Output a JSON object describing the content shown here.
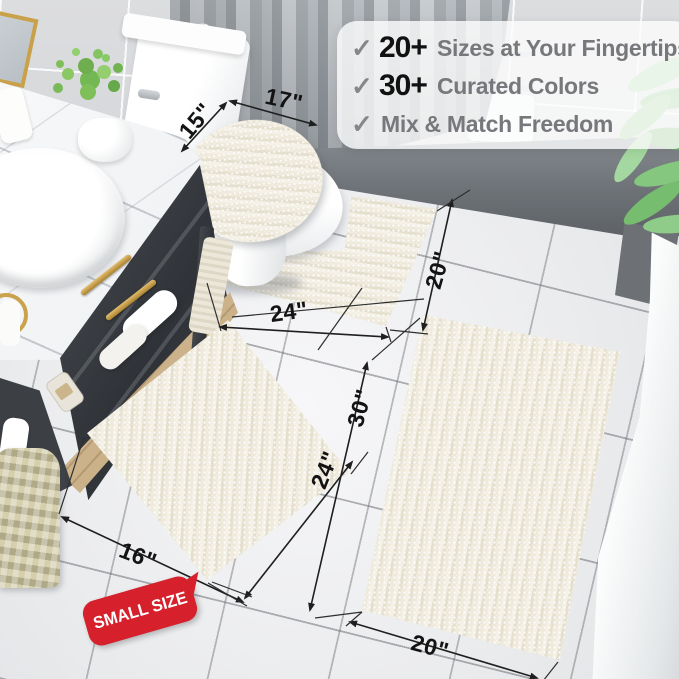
{
  "callout": {
    "check_glyph": "✓",
    "items": [
      {
        "count": "20+",
        "label": "Sizes at Your Fingertips"
      },
      {
        "count": "30+",
        "label": "Curated Colors"
      },
      {
        "count": "",
        "label": "Mix & Match Freedom"
      }
    ]
  },
  "badge": {
    "label": "SMALL SIZE"
  },
  "dimensions": {
    "lid_width": "17\"",
    "lid_depth": "15\"",
    "contour_width": "24\"",
    "contour_side": "20\"",
    "small_front": "16\"",
    "small_side": "24\"",
    "large_side": "30\"",
    "large_front": "20\""
  },
  "colors": {
    "badge_red": "#d6202c",
    "rug_cream": "#f0ebdd",
    "gold_accent": "#c9a24b",
    "callout_number": "#111111",
    "callout_text": "#76787b"
  }
}
